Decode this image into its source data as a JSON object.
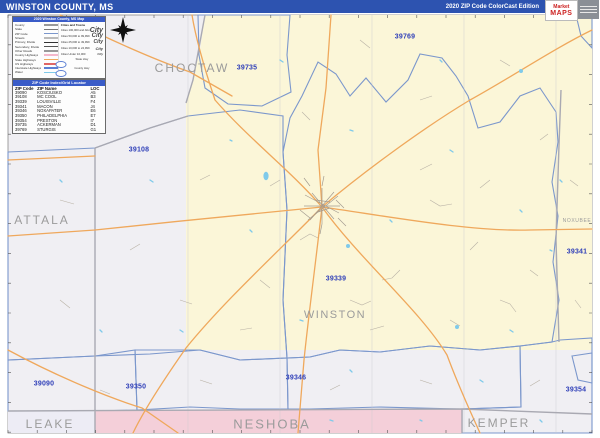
{
  "header": {
    "title": "WINSTON COUNTY, MS",
    "edition": "2020 ZIP Code ColorCast Edition",
    "brand": {
      "name_top": "Market",
      "name_bottom": "MAPS"
    }
  },
  "legend": {
    "title": "2020 Winston County, MS Map",
    "items": [
      {
        "label": "County",
        "color": "#999999"
      },
      {
        "label": "State",
        "color": "#777777"
      },
      {
        "label": "ZIP Code",
        "color": "#7b97cc"
      },
      {
        "label": "Streets",
        "color": "#bbbbbb"
      },
      {
        "label": "Primary, Divide",
        "color": "#333333"
      },
      {
        "label": "Secondary, Divide",
        "color": "#555555"
      },
      {
        "label": "Other Roads",
        "color": "#999999"
      },
      {
        "label": "County Highways",
        "color": "#f4b8cc"
      },
      {
        "label": "State Highways",
        "color": "#f0a95c"
      },
      {
        "label": "US Highways",
        "color": "#e06666"
      },
      {
        "label": "Interstate Highways",
        "color": "#5b7fd4"
      },
      {
        "label": "Water",
        "color": "#7fcaea"
      }
    ],
    "cities_header": "Cities and Towns",
    "city_sample": "City",
    "city_classes": [
      {
        "label": "Cities 100,000 and Above"
      },
      {
        "label": "Cities 50,000 to 99,999"
      },
      {
        "label": "Cities 25,000 to 49,999"
      },
      {
        "label": "Cities 10,000 to 24,999"
      },
      {
        "label": "Cities Under 10,000"
      }
    ],
    "shields": [
      {
        "label": "State Hwy"
      },
      {
        "label": "County Hwy"
      }
    ]
  },
  "zip_table": {
    "title": "ZIP Code Index/Grid Locator",
    "columns": [
      "ZIP Code",
      "ZIP Name",
      "LOC"
    ],
    "rows": [
      {
        "zip": "39090",
        "name": "KOSCIUSKO",
        "loc": "A5"
      },
      {
        "zip": "39108",
        "name": "MC COOL",
        "loc": "B3"
      },
      {
        "zip": "39339",
        "name": "LOUISVILLE",
        "loc": "F4"
      },
      {
        "zip": "39341",
        "name": "MACON",
        "loc": "J4"
      },
      {
        "zip": "39346",
        "name": "NOXAPATER",
        "loc": "E6"
      },
      {
        "zip": "39350",
        "name": "PHILADELPHIA",
        "loc": "E7"
      },
      {
        "zip": "39354",
        "name": "PRESTON",
        "loc": "I7"
      },
      {
        "zip": "39735",
        "name": "ACKERMAN",
        "loc": "D1"
      },
      {
        "zip": "39769",
        "name": "STURGIS",
        "loc": "G1"
      }
    ]
  },
  "map": {
    "colors": {
      "base_white": "#f0eff3",
      "yellow": "#fbf6d8",
      "yellow2": "#f7f2c6",
      "tan": "#e3cdb0",
      "mint": "#cfefe2",
      "mint2": "#cbeedd",
      "peach": "#f8dcbe",
      "pink": "#f8d8d8",
      "pink2": "#f4cfd9",
      "lavender": "#e2def3",
      "lavender2": "#edecf5",
      "cyan_piece": "#d6edf4",
      "white_piece": "#eef0ee",
      "zip_border": "#7b97cc",
      "county_border": "#a9a9b2",
      "road_orange": "#efa85c",
      "road_gray": "#b9b2a6",
      "water": "#7fcaea",
      "zip_label": "#2f3fb8",
      "county_label": "#9b9b9b",
      "header_bar": "#2d53b0"
    },
    "zip_labels": [
      {
        "text": "39735"
      },
      {
        "text": "39769"
      },
      {
        "text": "39108"
      },
      {
        "text": "39339"
      },
      {
        "text": "39341"
      },
      {
        "text": "39346"
      },
      {
        "text": "39350"
      },
      {
        "text": "39090"
      },
      {
        "text": "39354"
      }
    ],
    "county_labels": [
      {
        "text": "CHOCTAW"
      },
      {
        "text": "ATTALA"
      },
      {
        "text": "WINSTON"
      },
      {
        "text": "NOXUBEE"
      },
      {
        "text": "NESHOBA"
      },
      {
        "text": "LEAKE"
      },
      {
        "text": "KEMPER"
      }
    ]
  }
}
